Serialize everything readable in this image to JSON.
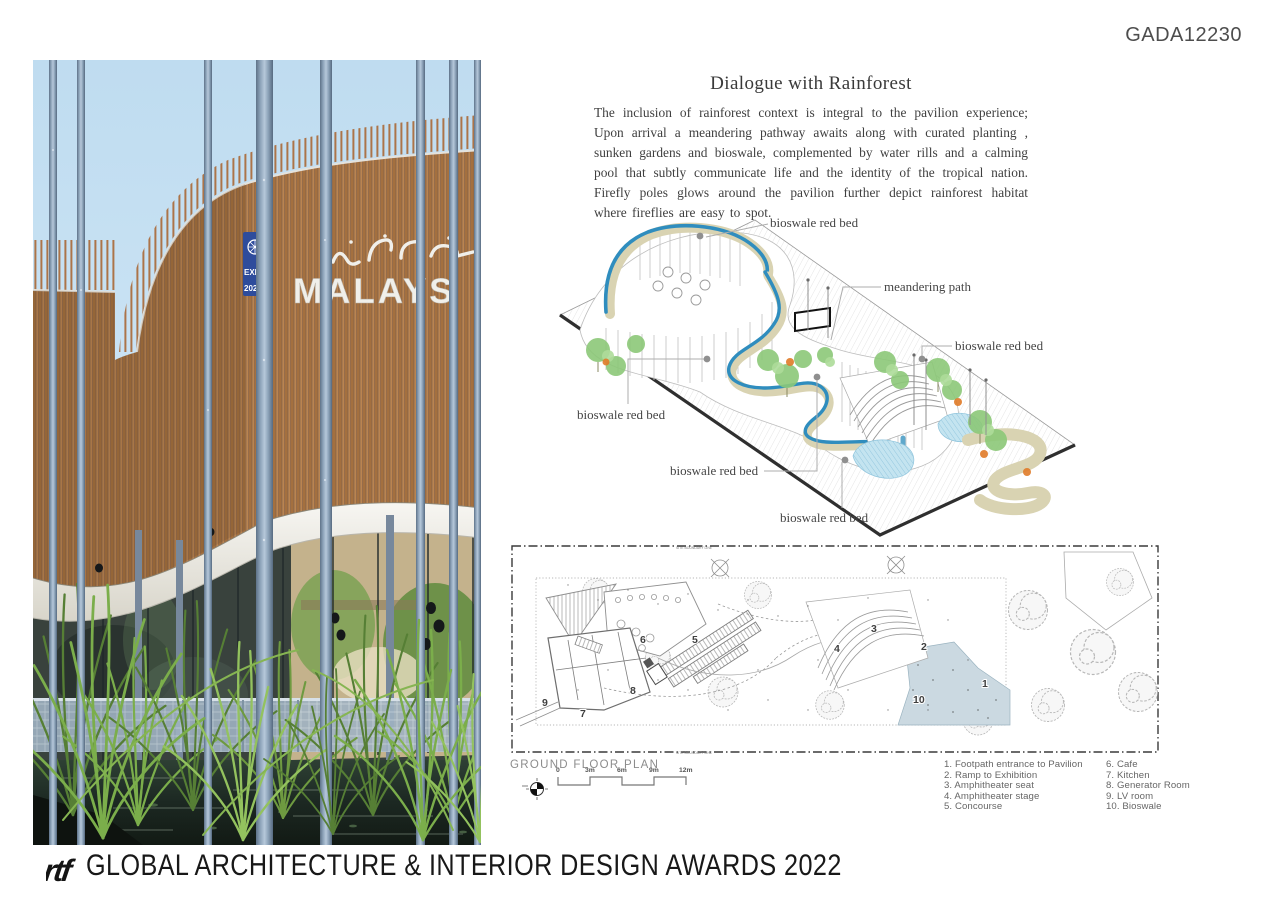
{
  "header": {
    "code": "GADA12230"
  },
  "article": {
    "title": "Dialogue with Rainforest",
    "body": "The inclusion of rainforest context is integral to the pavilion experience; Upon arrival a meandering pathway awaits along with curated planting , sunken gardens and bioswale, complemented by water rills and a calming pool that subtly communicate life and the identity of the tropical nation. Firefly poles glows around the pavilion further depict rainforest habitat where fireflies are easy to spot."
  },
  "photo": {
    "sign_text": "MALAYS",
    "badge_text_top": "EXPO",
    "badge_text_bottom": "2020"
  },
  "diagram": {
    "labels": [
      {
        "id": "top",
        "text": "bioswale red bed"
      },
      {
        "id": "meandering",
        "text": "meandering path"
      },
      {
        "id": "right",
        "text": "bioswale red bed"
      },
      {
        "id": "left",
        "text": "bioswale red bed"
      },
      {
        "id": "mid",
        "text": "bioswale red bed"
      },
      {
        "id": "bottom",
        "text": "bioswale red bed"
      }
    ]
  },
  "plan": {
    "title": "GROUND FLOOR PLAN",
    "boundary_label": "SITE BOUNDARY LINE",
    "scale_labels": [
      "0",
      "3m",
      "6m",
      "9m",
      "12m"
    ],
    "numbers": [
      "1",
      "2",
      "3",
      "4",
      "5",
      "6",
      "7",
      "8",
      "9",
      "10"
    ],
    "legend_col1": [
      "1. Footpath entrance to Pavilion",
      "2. Ramp to Exhibition",
      "3. Amphitheater seat",
      "4. Amphitheater stage",
      "5. Concourse"
    ],
    "legend_col2": [
      "6. Cafe",
      "7. Kitchen",
      "8. Generator Room",
      "9. LV room",
      "10. Bioswale"
    ]
  },
  "footer": {
    "logo": "rtf",
    "award_text": "GLOBAL ARCHITECTURE & INTERIOR DESIGN AWARDS 2022"
  },
  "colors": {
    "timber": "#A9744A",
    "firefly_pole": "#8CA2B8",
    "water_rill": "#2F8DBE",
    "path_tan": "#D9D3B2",
    "pool": "#BFE3EF",
    "tree_green": "#8CC878",
    "tree_accent_orange": "#E07B28",
    "bioswale_fill": "#CBD9E1",
    "text_dark": "#3F3F3F"
  }
}
